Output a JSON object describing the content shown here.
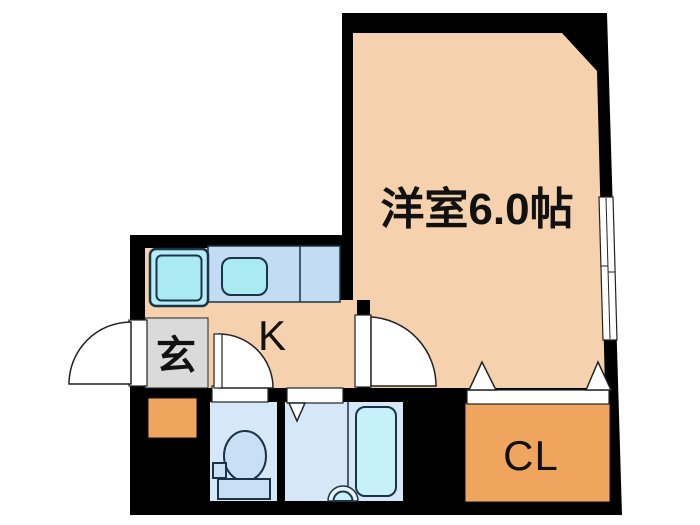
{
  "plan": {
    "type": "apartment-floor-plan",
    "rooms": {
      "western_room": {
        "label": "洋室6.0帖"
      },
      "kitchen": {
        "label": "K"
      },
      "entrance": {
        "label": "玄"
      },
      "closet": {
        "label": "CL"
      }
    },
    "features": [
      "entrance-swing-door",
      "kitchen-swing-door",
      "toilet-swing-door",
      "bath-folding-door",
      "closet-double-door",
      "sliding-window"
    ],
    "colors": {
      "wall": "#000000",
      "floor_peach": "#F5D1AD",
      "closet_orange": "#F0A55E",
      "entrance_gray": "#DADADA",
      "counter_blue": "#C3DCF3",
      "wet_floor_blue": "#D6E8F8",
      "fixture_cyan": "#A9EAF3",
      "sink_cyan": "#B7ECF4",
      "tub_cyan": "#C6F0FA",
      "fixture_fill_blue": "#C9E0F4",
      "outline_dark": "#1A3347"
    }
  }
}
